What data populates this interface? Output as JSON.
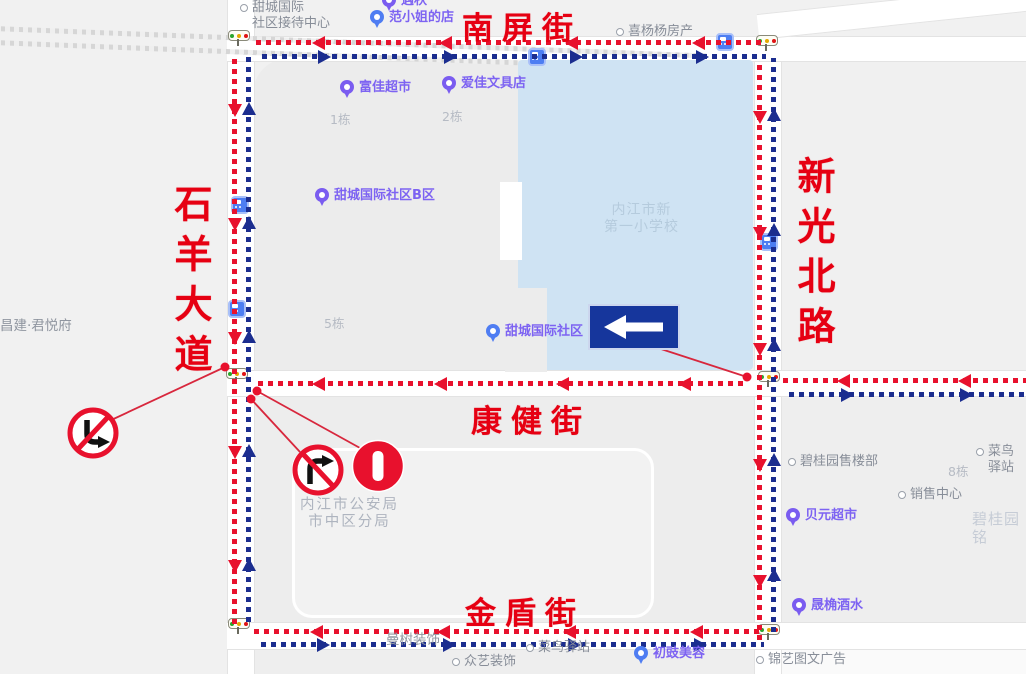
{
  "street_names": {
    "nanping": "南屏街",
    "shiyang": "石羊大道",
    "xinguang": "新光北路",
    "kangjian": "康健街",
    "jindun": "金盾街"
  },
  "pois": [
    {
      "name": "jiedai-center",
      "label": "甜城国际\n社区接待中心",
      "style": "ring",
      "x": 240,
      "y": 0
    },
    {
      "name": "yuqiu-shop",
      "label": "遇秋",
      "style": "purple-pin",
      "x": 382,
      "y": -7
    },
    {
      "name": "fanxiaojie-shop",
      "label": "范小姐的店",
      "style": "blue-pin",
      "x": 370,
      "y": 10
    },
    {
      "name": "xiyangyang-fangchan",
      "label": "喜杨杨房产",
      "style": "ring",
      "x": 616,
      "y": 24
    },
    {
      "name": "fujia-supermarket",
      "label": "富佳超市",
      "style": "purple-pin",
      "x": 340,
      "y": 80
    },
    {
      "name": "aijia-stationery",
      "label": "爱佳文具店",
      "style": "purple-pin",
      "x": 442,
      "y": 76
    },
    {
      "name": "building-1",
      "label": "1栋",
      "style": "building",
      "x": 330,
      "y": 112
    },
    {
      "name": "building-2",
      "label": "2栋",
      "style": "building",
      "x": 442,
      "y": 109
    },
    {
      "name": "tiancheng-b-district",
      "label": "甜城国际社区B区",
      "style": "purple-pin",
      "x": 315,
      "y": 188
    },
    {
      "name": "neijiang-first-primary-school",
      "label": "内江市新\n第一小学校",
      "style": "school",
      "x": 604,
      "y": 202
    },
    {
      "name": "changjian-junyuefu",
      "label": "昌建·君悦府",
      "style": "gray",
      "x": 0,
      "y": 318
    },
    {
      "name": "building-5",
      "label": "5栋",
      "style": "building",
      "x": 324,
      "y": 316
    },
    {
      "name": "tiancheng-community",
      "label": "甜城国际社区",
      "style": "blue-pin",
      "x": 486,
      "y": 324
    },
    {
      "name": "bigui-yuan-sales",
      "label": "碧桂园售楼部",
      "style": "ring",
      "x": 788,
      "y": 454
    },
    {
      "name": "cainiao-right",
      "label": "菜鸟驿站",
      "style": "ring",
      "x": 976,
      "y": 444
    },
    {
      "name": "building-8",
      "label": "8栋",
      "style": "building",
      "x": 948,
      "y": 464
    },
    {
      "name": "sales-center",
      "label": "销售中心",
      "style": "ring",
      "x": 898,
      "y": 487
    },
    {
      "name": "beiyuan-supermarket",
      "label": "贝元超市",
      "style": "purple-pin",
      "x": 786,
      "y": 508
    },
    {
      "name": "biguiyuan-faint",
      "label": "碧桂园铭",
      "style": "faint",
      "x": 972,
      "y": 510
    },
    {
      "name": "police-bureau",
      "label": "内江市公安局\n市中区分局",
      "style": "building-lg",
      "x": 300,
      "y": 497
    },
    {
      "name": "shengjue-liquor",
      "label": "晟桷酒水",
      "style": "purple-pin",
      "x": 792,
      "y": 598
    },
    {
      "name": "manshu-decoration",
      "label": "曼树装饰",
      "style": "gray",
      "x": 386,
      "y": 632
    },
    {
      "name": "cainiao-bottom",
      "label": "菜鸟驿站",
      "style": "ring",
      "x": 526,
      "y": 640
    },
    {
      "name": "zhongyi-decoration",
      "label": "众艺装饰",
      "style": "ring",
      "x": 452,
      "y": 654
    },
    {
      "name": "chuchi-beauty",
      "label": "初豉美容",
      "style": "blue-pin",
      "x": 634,
      "y": 646
    },
    {
      "name": "jinyi-ad",
      "label": "锦艺图文广告",
      "style": "ring",
      "x": 756,
      "y": 652
    }
  ],
  "flows": [
    {
      "name": "nanping-westbound",
      "color": "red",
      "orient": "h",
      "dir": "left",
      "x": 256,
      "y": 40,
      "len": 506
    },
    {
      "name": "nanping-eastbound",
      "color": "blue",
      "orient": "h",
      "dir": "right",
      "x": 262,
      "y": 54,
      "len": 504
    },
    {
      "name": "shiyang-southbound",
      "color": "red",
      "orient": "v",
      "dir": "down",
      "x": 232,
      "y": 54,
      "len": 570
    },
    {
      "name": "shiyang-northbound",
      "color": "blue",
      "orient": "v",
      "dir": "up",
      "x": 246,
      "y": 52,
      "len": 570
    },
    {
      "name": "kangjian-westbound",
      "color": "red",
      "orient": "h",
      "dir": "left",
      "x": 258,
      "y": 381,
      "len": 488
    },
    {
      "name": "kangjian-east-westbound",
      "color": "red",
      "orient": "h",
      "dir": "left",
      "x": 783,
      "y": 378,
      "len": 243
    },
    {
      "name": "kangjian-east-eastbound",
      "color": "blue",
      "orient": "h",
      "dir": "right",
      "x": 789,
      "y": 392,
      "len": 237
    },
    {
      "name": "jindun-westbound",
      "color": "red",
      "orient": "h",
      "dir": "left",
      "x": 254,
      "y": 629,
      "len": 506
    },
    {
      "name": "jindun-eastbound",
      "color": "blue",
      "orient": "h",
      "dir": "right",
      "x": 261,
      "y": 642,
      "len": 503
    },
    {
      "name": "xinguang-southbound",
      "color": "red",
      "orient": "v",
      "dir": "down",
      "x": 757,
      "y": 60,
      "len": 580
    },
    {
      "name": "xinguang-northbound",
      "color": "blue",
      "orient": "v",
      "dir": "up",
      "x": 771,
      "y": 58,
      "len": 574
    }
  ],
  "traffic_signs": [
    "no-left-turn-sign",
    "no-right-turn-sign",
    "no-entry-sign",
    "one-way-left-sign"
  ],
  "traffic_lights": [
    {
      "x": 228,
      "y": 30
    },
    {
      "x": 756,
      "y": 35
    },
    {
      "x": 226,
      "y": 368
    },
    {
      "x": 758,
      "y": 371
    },
    {
      "x": 228,
      "y": 618
    },
    {
      "x": 758,
      "y": 624
    }
  ],
  "bus_stops": [
    {
      "x": 231,
      "y": 196
    },
    {
      "x": 528,
      "y": 48
    },
    {
      "x": 716,
      "y": 33
    },
    {
      "x": 760,
      "y": 233
    },
    {
      "x": 228,
      "y": 300
    }
  ],
  "colors": {
    "red_arrow": "#e8112d",
    "blue_arrow": "#1b2d8f",
    "street_name_red": "#e60012",
    "water": "#cfe3f3",
    "sign_navy": "#16369c"
  }
}
